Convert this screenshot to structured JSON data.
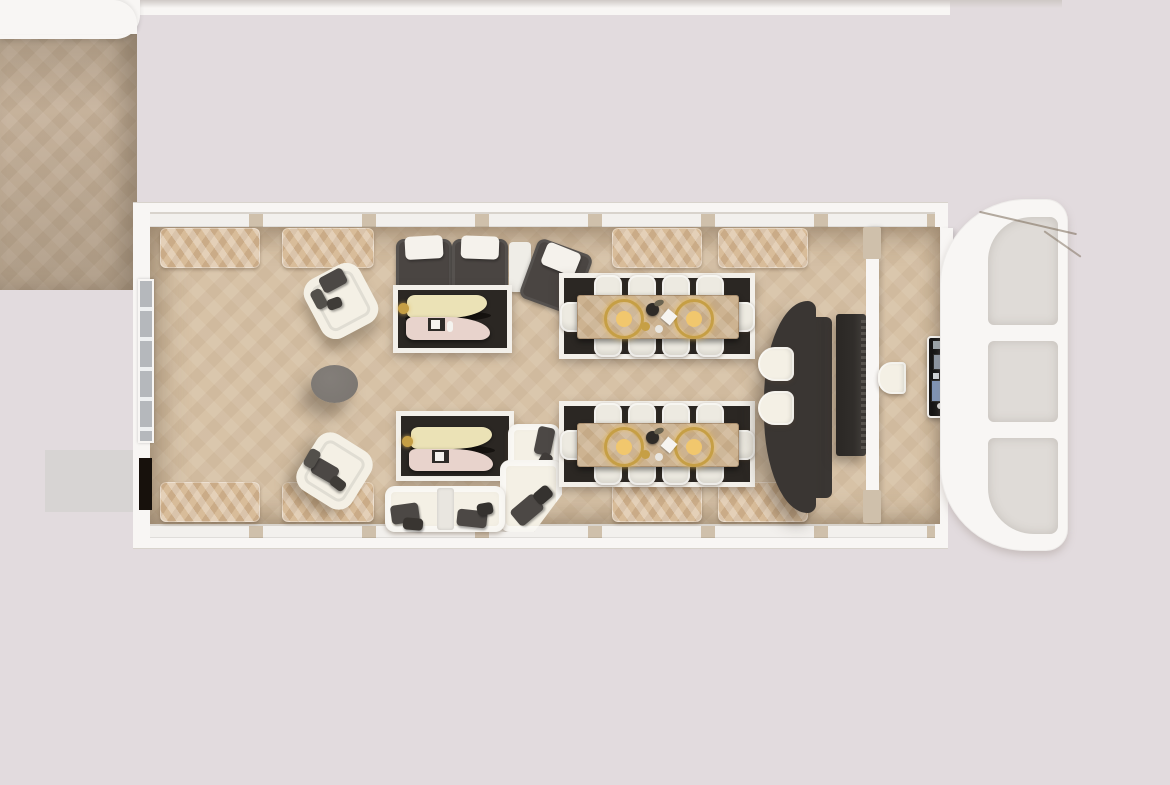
{
  "scene": {
    "kind": "photorealistic top-down interior floor plan render",
    "vehicle": "elongated saloon coach with rounded glazed front end",
    "text_visible": "none",
    "regions": {
      "adjacent_section": "partially visible section at left edge",
      "main_saloon": "lounge + dining saloon with wall benches and window bands",
      "vestibule": "entry vestibule behind partition with control panel",
      "front_nose": "rounded white front frame with three windshield panes"
    }
  },
  "furniture_inventory": {
    "wall_benches": 8,
    "dark_sectional_sofa_seats": 3,
    "white_armchairs": 2,
    "round_side_table": 1,
    "lounge_rugs_with_coffee_tables": 2,
    "white_sectional_sofa_seats": 4,
    "dining_tables": 2,
    "dining_chairs_per_table": 10,
    "gold_charger_plates_per_table": 2,
    "bar_counter": 1,
    "bar_stools": 2,
    "tv_screen": 1,
    "vestibule_stool": 1,
    "control_panel": 1
  },
  "palette": {
    "bg": "#e2dbde",
    "shell": "#f8f6f4",
    "shell-line": "#d8d3cc",
    "window-band": "#f2f0ed",
    "post": "#cfc0ab",
    "floor-main": "#d7c2a6",
    "floor-left": "#c6b29b",
    "glass": "#b5b8bc",
    "door-dark": "#17110c",
    "bench": "#d8bc99",
    "rug-dark": "#2b2723",
    "rug-border": "#f3f0ea",
    "sofa-dark": "#4a4542",
    "sofa-light": "#f4f0e5",
    "pillow-light": "#f5f2ec",
    "pillow-dark": "#4c4845",
    "chair": "#edeae1",
    "table-wood": "#cdb391",
    "charger-gold": "#c69f45",
    "charger-fill": "#f1c76d",
    "coffee-cream": "#ebe2b6",
    "coffee-pink": "#e8d3cc",
    "coffee-dark": "#15120f",
    "side-gray": "#7a7570",
    "counter": "#3a3633",
    "tv": "#312e2b",
    "block-gray": "#d7d4d3",
    "panel-black": "#161515",
    "panel-blue": "#5563e8",
    "panel-screen": "#7f94b5",
    "nose-pane": "#dfdbd7",
    "shadow": "#cfc9c6"
  }
}
